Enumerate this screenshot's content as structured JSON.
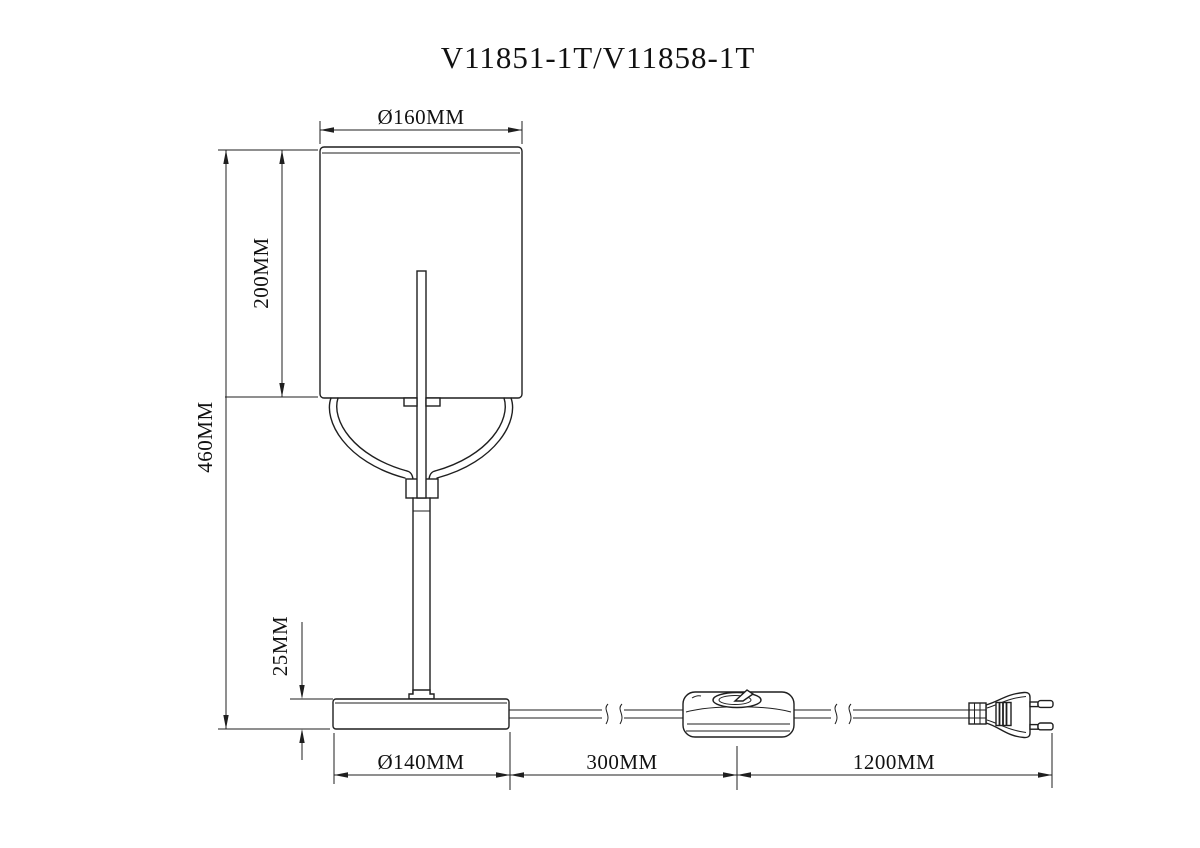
{
  "title": "V11851-1T/V11858-1T",
  "drawing": {
    "subject": "Table lamp dimensional line drawing",
    "view": "Side elevation with power cord, inline switch and two-pin plug"
  },
  "dimensions": {
    "shade_diameter": "Ø160MM",
    "shade_height": "200MM",
    "total_height": "460MM",
    "base_height": "25MM",
    "base_diameter": "Ø140MM",
    "base_to_switch": "300MM",
    "switch_to_plug": "1200MM"
  },
  "colors": {
    "background": "#ffffff",
    "line": "#1f1f1f"
  }
}
